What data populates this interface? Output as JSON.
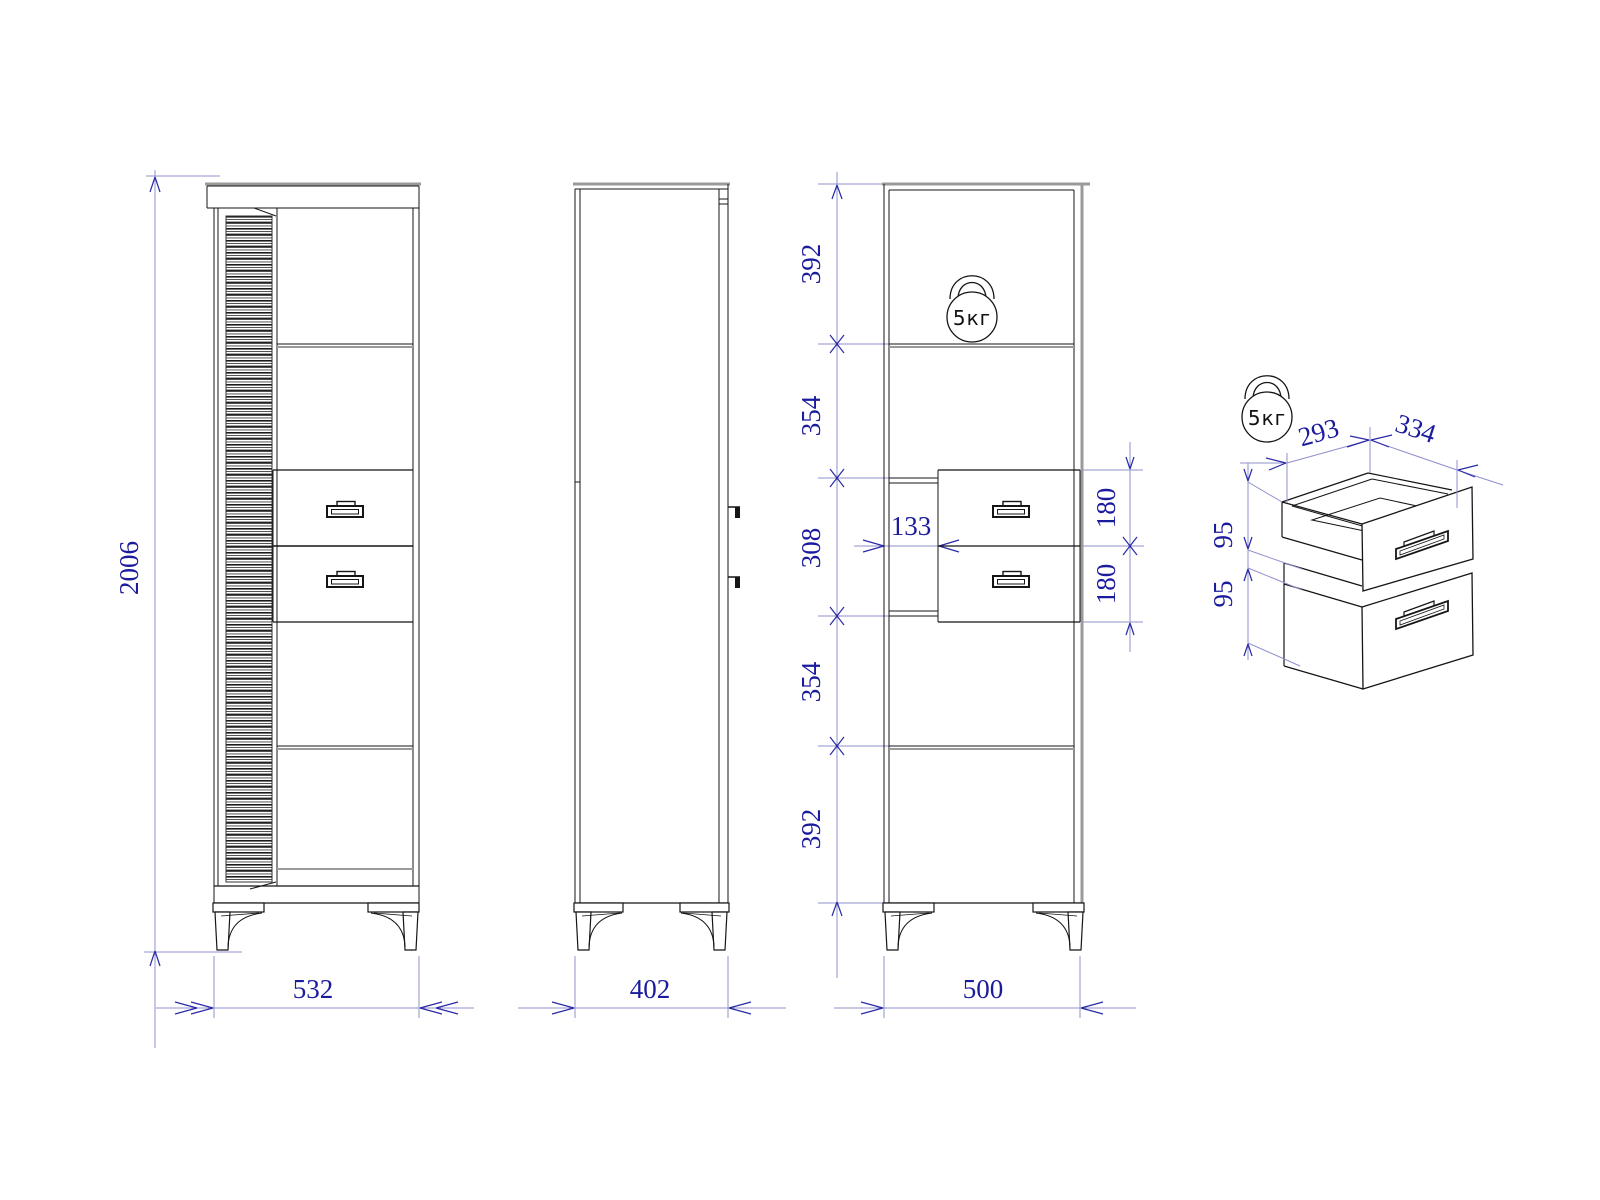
{
  "drawing": {
    "front_view": {
      "height": "2006",
      "width": "532"
    },
    "side_view": {
      "width": "402"
    },
    "section_view": {
      "segments": [
        "392",
        "354",
        "308",
        "354",
        "392"
      ],
      "drawer_fronts": [
        "180",
        "180"
      ],
      "drawer_offset": "133",
      "width": "500",
      "load_label": "5кг"
    },
    "detail_view": {
      "depth": "293",
      "width": "334",
      "drawer_heights": [
        "95",
        "95"
      ],
      "load_label": "5кг"
    }
  }
}
